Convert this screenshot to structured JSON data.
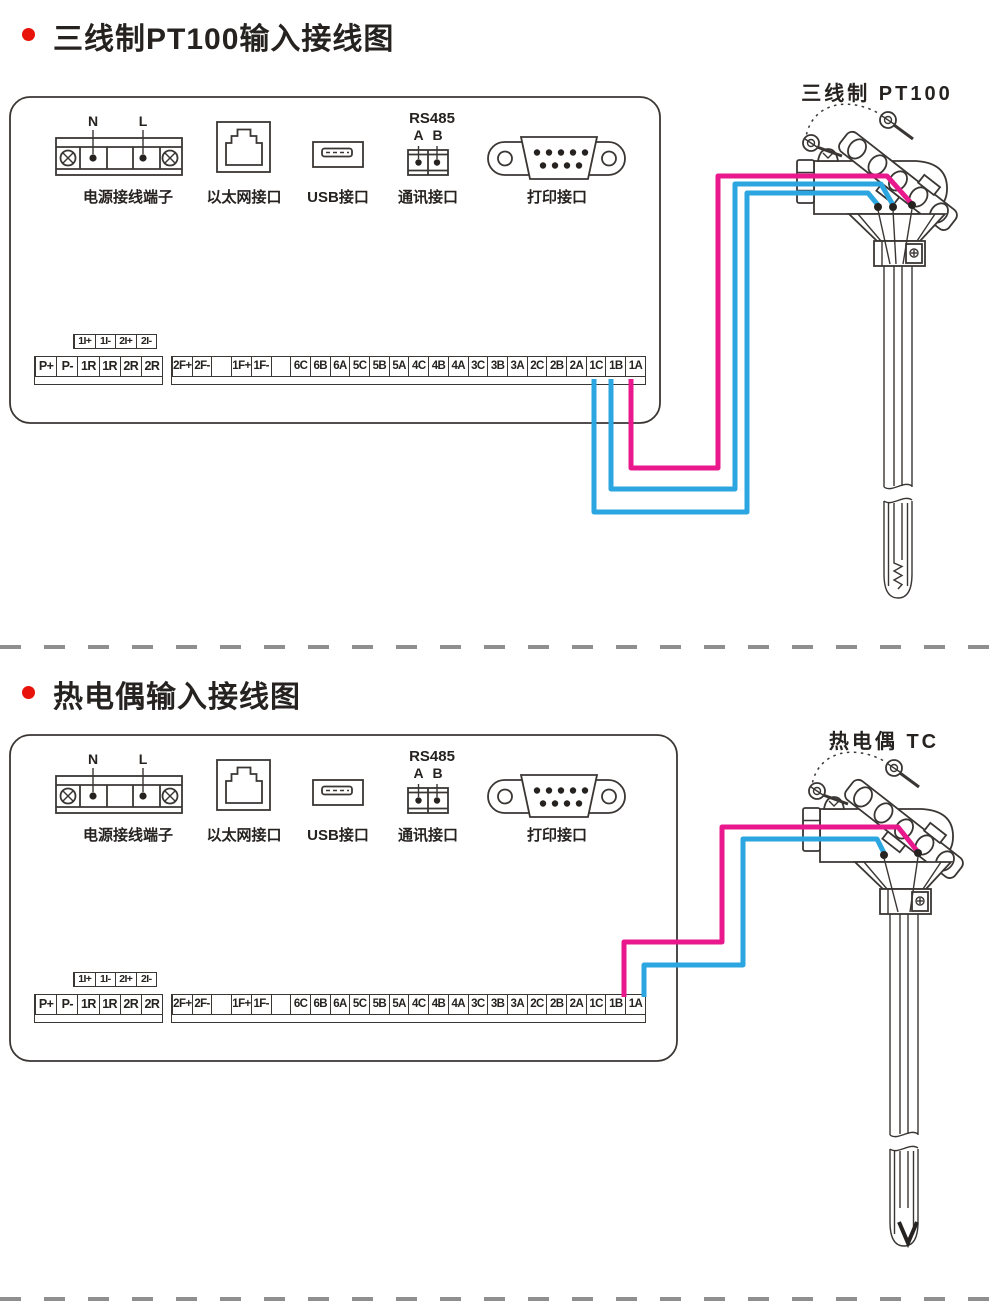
{
  "colors": {
    "wire_pink": "#e9188c",
    "wire_blue": "#2ba6e0",
    "bullet_red": "#e8130b",
    "line_color": "#3a3634",
    "divider_color": "#8f8f8f",
    "text_color": "#262220"
  },
  "ports": {
    "power_label": "电源接线端子",
    "power_n": "N",
    "power_l": "L",
    "ethernet_label": "以太网接口",
    "usb_label": "USB接口",
    "comm_label": "通讯接口",
    "comm_protocol": "RS485",
    "comm_a": "A",
    "comm_b": "B",
    "print_label": "打印接口"
  },
  "strips": {
    "current_cells": [
      "1I+",
      "1I-",
      "2I+",
      "2I-"
    ],
    "left_cells": [
      "P+",
      "P-",
      "1R",
      "1R",
      "2R",
      "2R"
    ],
    "right_cells": [
      "2F+",
      "2F-",
      "",
      "1F+",
      "1F-",
      "",
      "6C",
      "6B",
      "6A",
      "5C",
      "5B",
      "5A",
      "4C",
      "4B",
      "4A",
      "3C",
      "3B",
      "3A",
      "2C",
      "2B",
      "2A",
      "1C",
      "1B",
      "1A"
    ]
  },
  "sections": [
    {
      "title": "三线制PT100输入接线图",
      "sensor_label": "三线制 PT100",
      "connections": [
        {
          "terminal": "1C",
          "wire": "blue"
        },
        {
          "terminal": "1B",
          "wire": "blue"
        },
        {
          "terminal": "1A",
          "wire": "pink"
        }
      ]
    },
    {
      "title": "热电偶输入接线图",
      "sensor_label": "热电偶 TC",
      "connections": [
        {
          "terminal": "1B",
          "wire": "pink"
        },
        {
          "terminal": "1A",
          "wire": "blue"
        }
      ]
    }
  ]
}
